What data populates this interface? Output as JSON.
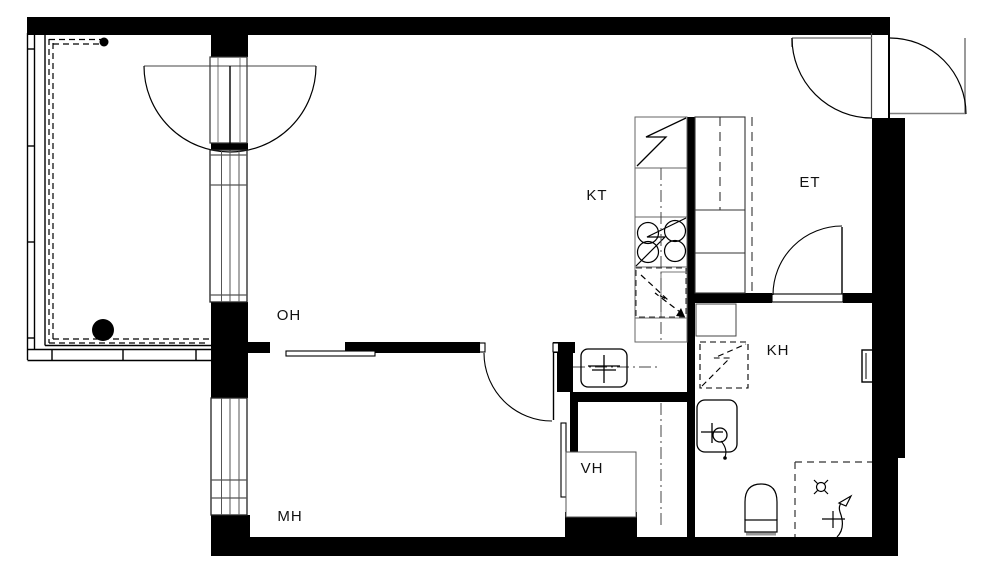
{
  "plan": {
    "type": "apartment-floor-plan",
    "colors": {
      "wall": "#000000",
      "line": "#333333",
      "muted_line": "#808080",
      "background": "#ffffff"
    },
    "rooms": {
      "kt": {
        "label": "KT"
      },
      "et": {
        "label": "ET"
      },
      "oh": {
        "label": "OH"
      },
      "kh": {
        "label": "KH"
      },
      "vh": {
        "label": "VH"
      },
      "mh": {
        "label": "MH"
      }
    },
    "fixture_icons": [
      "fridge-icon",
      "stove-icon",
      "dishwasher-icon",
      "kitchen-sink-icon",
      "wardrobe-icon",
      "washing-machine-icon",
      "laundry-sink-icon",
      "toilet-icon",
      "shower-mixer-icon",
      "floor-drain-icon",
      "balcony-drain-icon",
      "towel-radiator-icon"
    ]
  }
}
